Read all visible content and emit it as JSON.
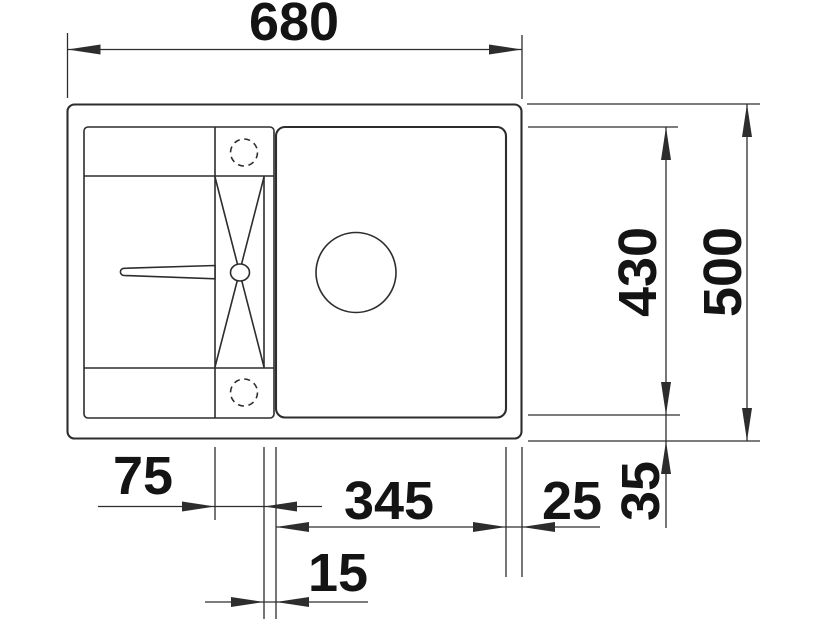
{
  "drawing": {
    "subject": "Kitchen sink with drainboard — top view dimension drawing",
    "units": "mm",
    "colors": {
      "background": "#ffffff",
      "line": "#2d2d2d",
      "text": "#141414"
    },
    "dimensions": {
      "overall_width": "680",
      "overall_depth": "500",
      "inner_depth": "430",
      "drainer_channel_width": "75",
      "bowl_width": "345",
      "channel_divider_width": "15",
      "bowl_right_offset": "25",
      "bowl_bottom_offset": "35"
    }
  }
}
